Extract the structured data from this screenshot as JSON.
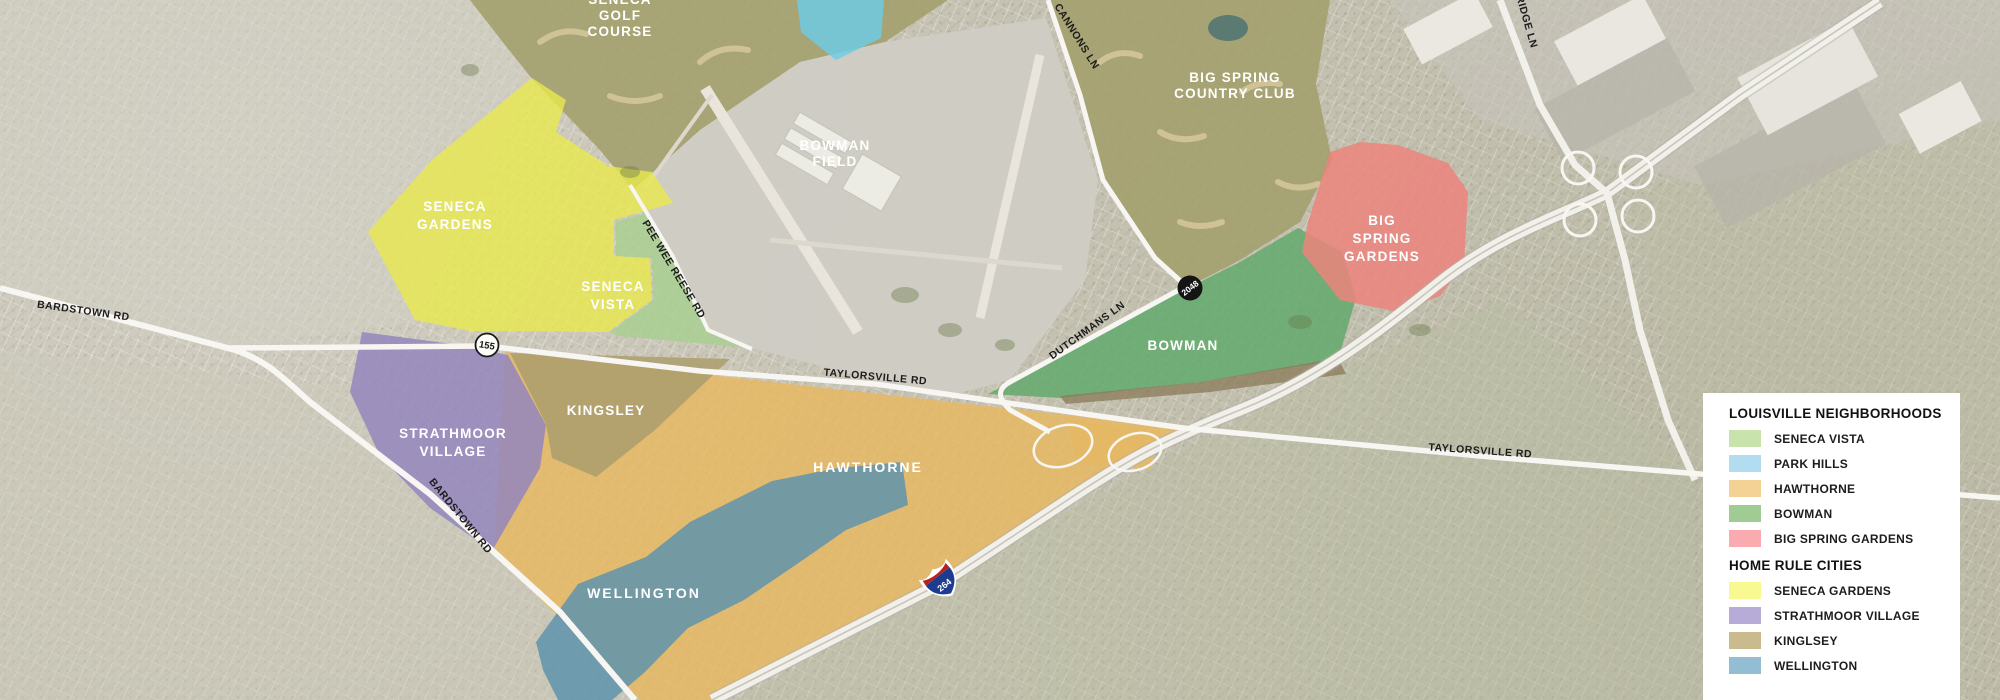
{
  "colors": {
    "seneca_gardens": "#e9e94d",
    "seneca_vista": "#a9cf92",
    "park_hills": "#6ecbe4",
    "strathmoor_village": "#9486bd",
    "kingsley": "#ac9e6d",
    "hawthorne": "#e6b863",
    "wellington": "#5f93ad",
    "bowman": "#63a96c",
    "big_spring_gardens": "#ec847d",
    "golf_course": "#a3a06e",
    "airfield": "#cfccc4"
  },
  "areas": {
    "seneca_golf_course": {
      "lines": [
        "SENECA",
        "GOLF",
        "COURSE"
      ]
    },
    "bowman_field": {
      "lines": [
        "BOWMAN",
        "FIELD"
      ]
    },
    "big_spring_country_club": {
      "lines": [
        "BIG SPRING",
        "COUNTRY CLUB"
      ]
    },
    "seneca_gardens": {
      "lines": [
        "SENECA",
        "GARDENS"
      ]
    },
    "seneca_vista": {
      "lines": [
        "SENECA",
        "VISTA"
      ]
    },
    "strathmoor_village": {
      "lines": [
        "STRATHMOOR",
        "VILLAGE"
      ]
    },
    "kingsley": {
      "lines": [
        "KINGSLEY"
      ]
    },
    "hawthorne": {
      "lines": [
        "HAWTHORNE"
      ]
    },
    "wellington": {
      "lines": [
        "WELLINGTON"
      ]
    },
    "bowman": {
      "lines": [
        "BOWMAN"
      ]
    },
    "big_spring_gardens": {
      "lines": [
        "BIG",
        "SPRING",
        "GARDENS"
      ]
    }
  },
  "roads": {
    "bardstown_rd": "BARDSTOWN RD",
    "taylorsville_rd": "TAYLORSVILLE RD",
    "pee_wee_reese_rd": "PEE WEE REESE RD",
    "dutchmans_ln": "DUTCHMANS LN",
    "cannons_ln": "CANNONS LN",
    "breckenridge_ln": "BRECKENRIDGE LN"
  },
  "shields": {
    "route_155": "155",
    "route_2048": "2048",
    "interstate_264": "264"
  },
  "legend": {
    "sections": [
      {
        "title": "LOUISVILLE NEIGHBORHOODS",
        "items": [
          {
            "label": "SENECA VISTA",
            "color": "#c8e3ac"
          },
          {
            "label": "PARK HILLS",
            "color": "#b2ddf1"
          },
          {
            "label": "HAWTHORNE",
            "color": "#f4d296"
          },
          {
            "label": "BOWMAN",
            "color": "#a0cb93"
          },
          {
            "label": "BIG SPRING GARDENS",
            "color": "#f9abaf"
          }
        ]
      },
      {
        "title": "HOME RULE CITIES",
        "items": [
          {
            "label": "SENECA GARDENS",
            "color": "#f9f992"
          },
          {
            "label": "STRATHMOOR VILLAGE",
            "color": "#b7abd7"
          },
          {
            "label": "KINGLSEY",
            "color": "#cabb8e"
          },
          {
            "label": "WELLINGTON",
            "color": "#93bdd2"
          }
        ]
      }
    ]
  }
}
